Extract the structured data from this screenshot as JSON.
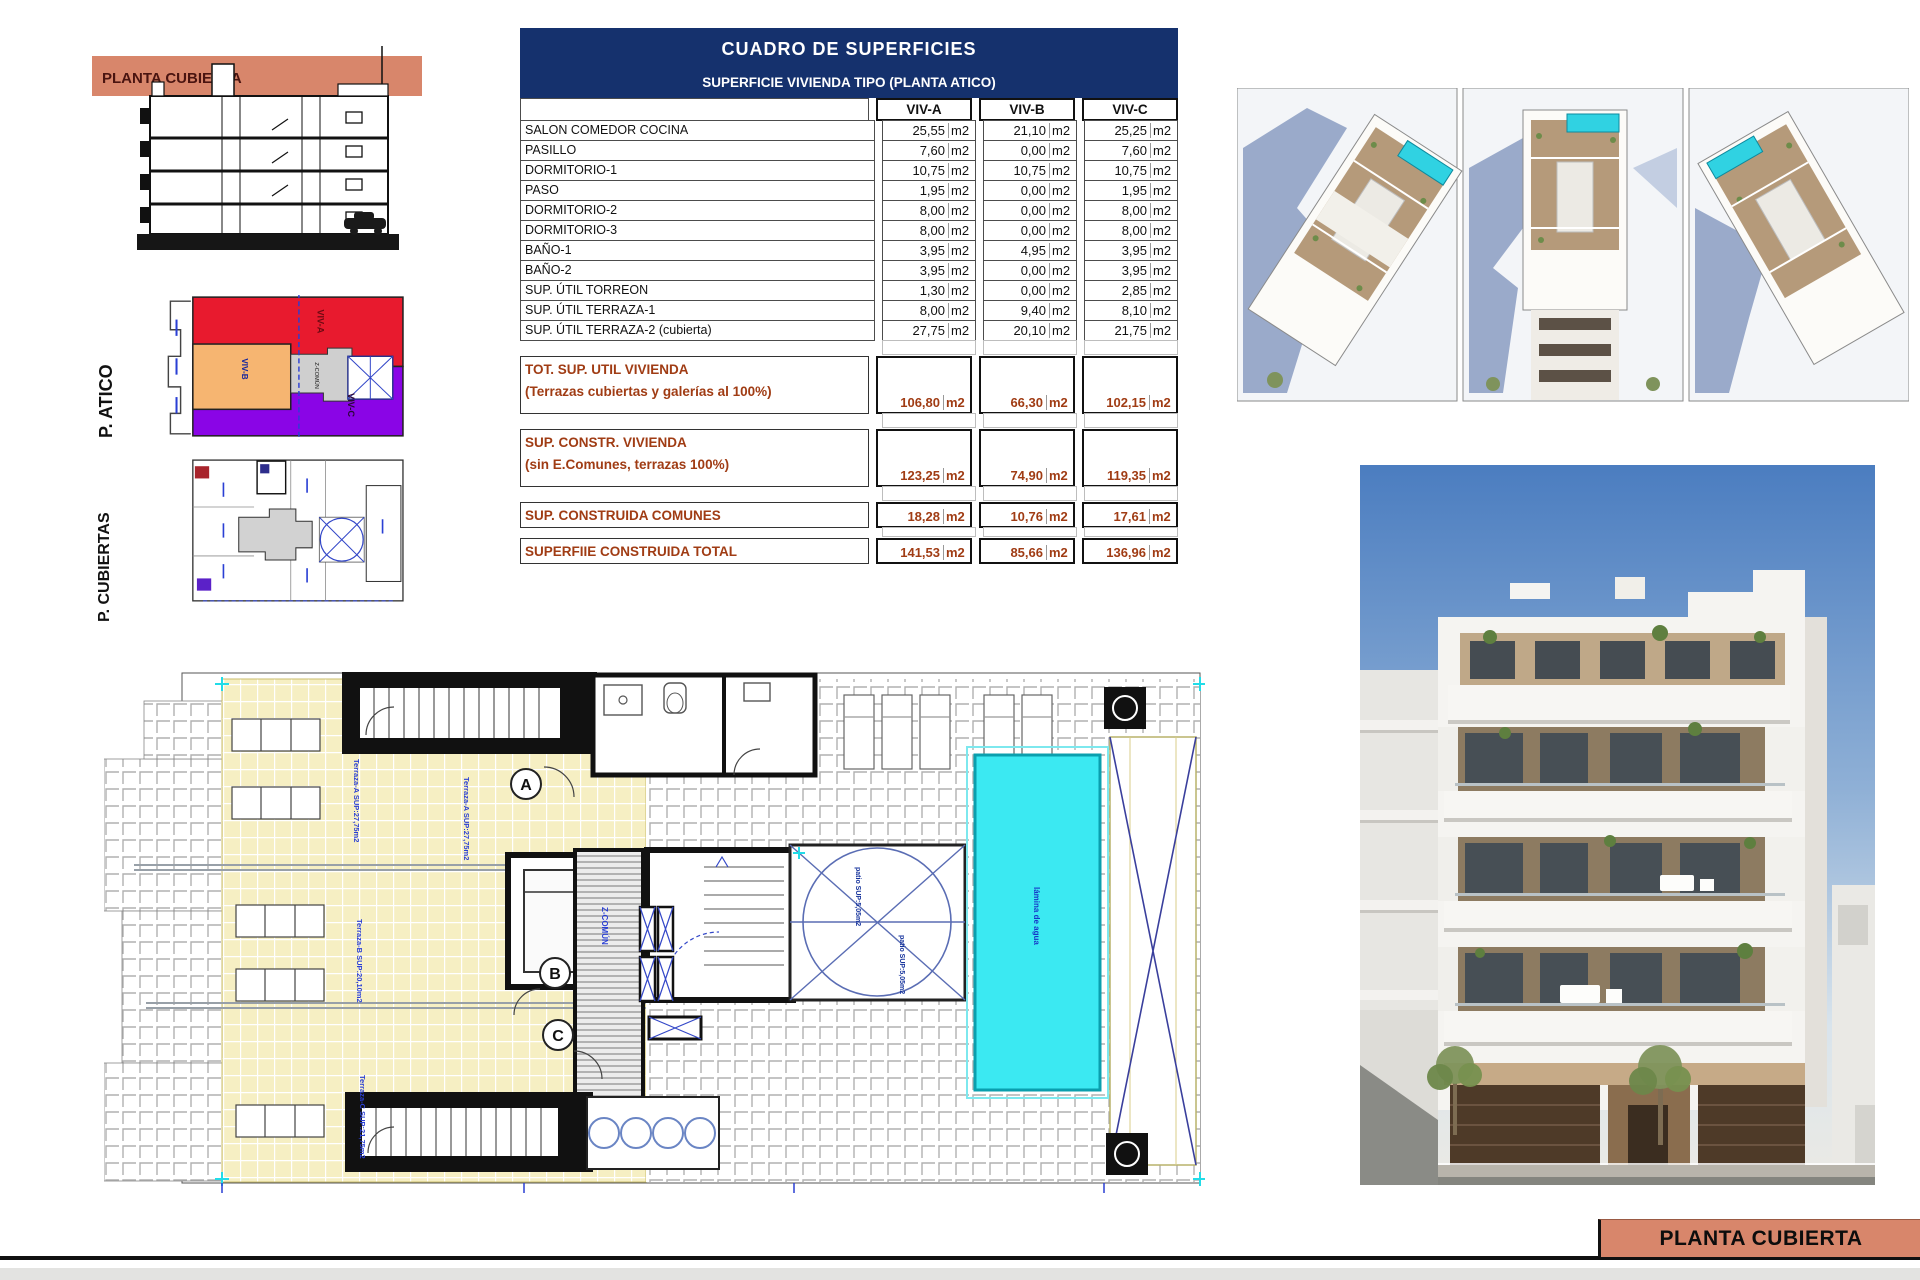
{
  "section": {
    "band_label": "PLANTA CUBIERTA"
  },
  "atico": {
    "label": "P. ATICO",
    "viv_a": "VIV-A",
    "viv_b": "VIV-B",
    "viv_c": "VIV-C",
    "core": "Z-COMÚN"
  },
  "cubiertas": {
    "label": "P. CUBIERTAS"
  },
  "table": {
    "title": "CUADRO DE SUPERFICIES",
    "subtitle": "SUPERFICIE VIVIENDA TIPO (PLANTA ATICO)",
    "columns": [
      "VIV-A",
      "VIV-B",
      "VIV-C"
    ],
    "unit": "m2",
    "rows": [
      {
        "label": "SALON COMEDOR COCINA",
        "a": "25,55",
        "b": "21,10",
        "c": "25,25"
      },
      {
        "label": "PASILLO",
        "a": "7,60",
        "b": "0,00",
        "c": "7,60"
      },
      {
        "label": "DORMITORIO-1",
        "a": "10,75",
        "b": "10,75",
        "c": "10,75"
      },
      {
        "label": "PASO",
        "a": "1,95",
        "b": "0,00",
        "c": "1,95"
      },
      {
        "label": "DORMITORIO-2",
        "a": "8,00",
        "b": "0,00",
        "c": "8,00"
      },
      {
        "label": "DORMITORIO-3",
        "a": "8,00",
        "b": "0,00",
        "c": "8,00"
      },
      {
        "label": "BAÑO-1",
        "a": "3,95",
        "b": "4,95",
        "c": "3,95"
      },
      {
        "label": "BAÑO-2",
        "a": "3,95",
        "b": "0,00",
        "c": "3,95"
      },
      {
        "label": "SUP. ÚTIL TORREON",
        "a": "1,30",
        "b": "0,00",
        "c": "2,85"
      },
      {
        "label": "SUP. ÚTIL TERRAZA-1",
        "a": "8,00",
        "b": "9,40",
        "c": "8,10"
      },
      {
        "label": "SUP. ÚTIL TERRAZA-2 (cubierta)",
        "a": "27,75",
        "b": "20,10",
        "c": "21,75"
      }
    ],
    "summary": [
      {
        "label1": "TOT. SUP. UTIL VIVIENDA",
        "label2": "(Terrazas cubiertas y galerías al 100%)",
        "a": "106,80",
        "b": "66,30",
        "c": "102,15"
      },
      {
        "label1": "SUP. CONSTR. VIVIENDA",
        "label2": "(sin E.Comunes, terrazas 100%)",
        "a": "123,25",
        "b": "74,90",
        "c": "119,35"
      },
      {
        "label1": "SUP. CONSTRUIDA COMUNES",
        "label2": "",
        "a": "18,28",
        "b": "10,76",
        "c": "17,61"
      },
      {
        "label1": "SUPERFIIE CONSTRUIDA TOTAL",
        "label2": "",
        "a": "141,53",
        "b": "85,66",
        "c": "136,96"
      }
    ]
  },
  "plan": {
    "letter_a": "A",
    "letter_b": "B",
    "letter_c": "C",
    "terraza_a": "Terraza-A SUP:27,75m2",
    "terraza_b": "Terraza-B SUP:20,10m2",
    "terraza_c": "Terraza-C SUP:21,75m2",
    "pool": "lámina de agua",
    "patio_top": "patio SUP:5,05m2",
    "patio_bottom": "patio SUP:5,05m2",
    "core": "Z-COMÚN"
  },
  "footer": {
    "label": "PLANTA CUBIERTA"
  },
  "colors": {
    "salmon": "#d8866b",
    "navy": "#15316d",
    "summary_brown": "#a03c14",
    "pool_cyan": "#3be9f2",
    "viv_a_red": "#e81a2e",
    "viv_b_orange": "#f6b571",
    "viv_c_purple": "#8a05e6"
  }
}
